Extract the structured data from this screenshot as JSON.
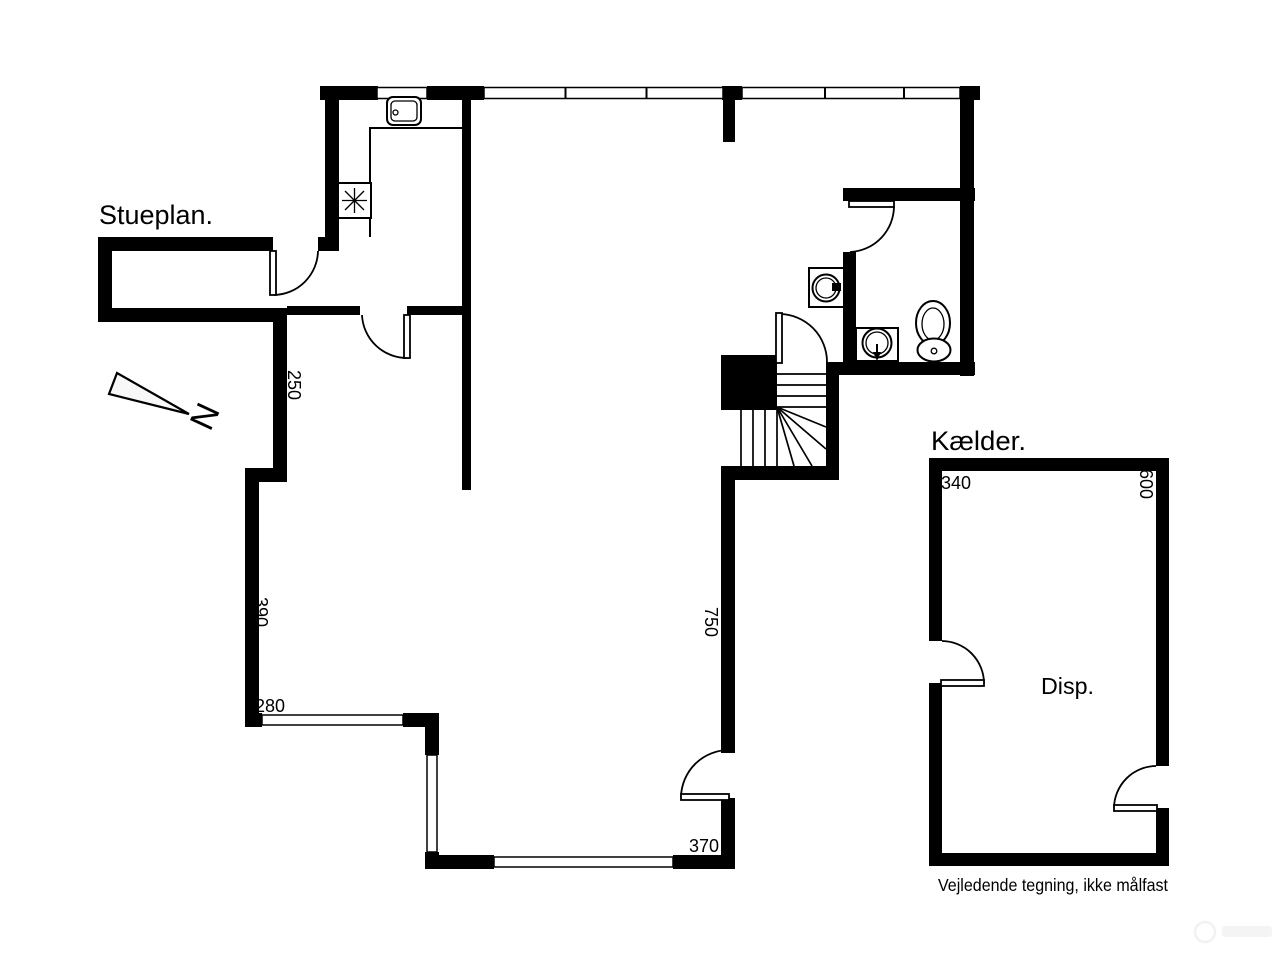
{
  "image": {
    "background": "#ffffff",
    "line_color": "#000000"
  },
  "floorplan": {
    "title": "Stueplan.",
    "north_label": "N",
    "dimensions": {
      "room_wall_250": "250",
      "left_wall_390": "390",
      "bottom_left_280": "280",
      "right_wall_750": "750",
      "bottom_right_370": "370"
    },
    "icons": [
      "north-arrow-icon",
      "kitchen-sink-icon",
      "stove-icon",
      "washing-machine-icon",
      "washbasin-icon",
      "toilet-icon",
      "stairs-icon"
    ]
  },
  "basement": {
    "title": "Kælder.",
    "room_label": "Disp.",
    "dimensions": {
      "top_340": "340",
      "right_600": "600"
    }
  },
  "footer": {
    "disclaimer": "Vejledende tegning, ikke målfast"
  }
}
